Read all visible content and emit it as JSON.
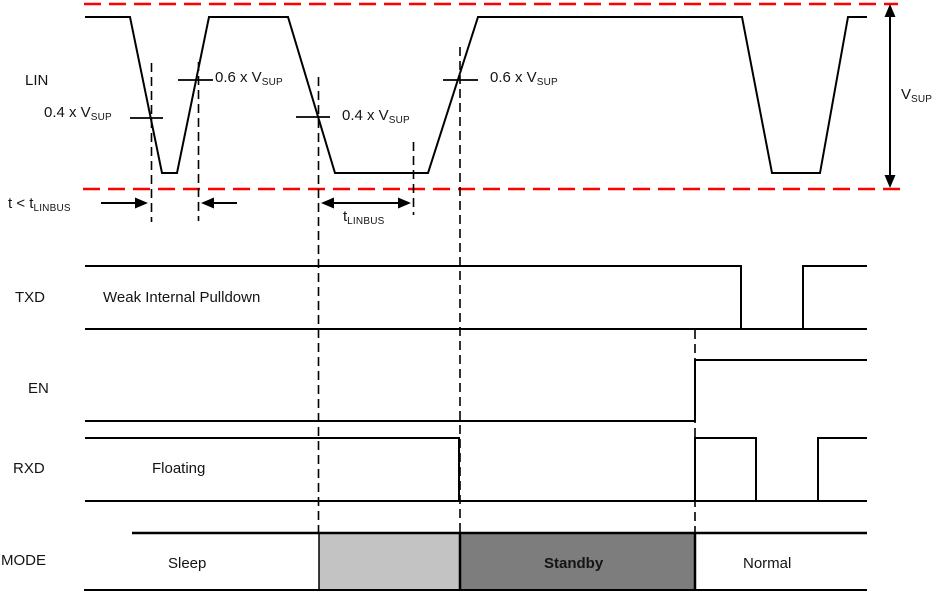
{
  "colors": {
    "waveform": "#000000",
    "supply_rail_dashed": "#ff0000",
    "mode_wake_fill": "#c3c3c3",
    "mode_standby_fill": "#7d7d7d"
  },
  "lin": {
    "label": "LIN",
    "vsup": {
      "main": "V",
      "sub": "SUP"
    },
    "th04_1": {
      "main": "0.4 x V",
      "sub": "SUP"
    },
    "th06_1": {
      "main": "0.6 x V",
      "sub": "SUP"
    },
    "th04_2": {
      "main": "0.4 x V",
      "sub": "SUP"
    },
    "th06_2": {
      "main": "0.6 x V",
      "sub": "SUP"
    },
    "t_short": {
      "main": "t < t",
      "sub": "LINBUS"
    },
    "t_linbus": {
      "main": "t",
      "sub": "LINBUS"
    }
  },
  "txd": {
    "label": "TXD",
    "state": "Weak Internal Pulldown"
  },
  "en": {
    "label": "EN"
  },
  "rxd": {
    "label": "RXD",
    "state": "Floating"
  },
  "mode": {
    "label": "MODE",
    "states": {
      "sleep": "Sleep",
      "standby": "Standby",
      "normal": "Normal"
    }
  }
}
